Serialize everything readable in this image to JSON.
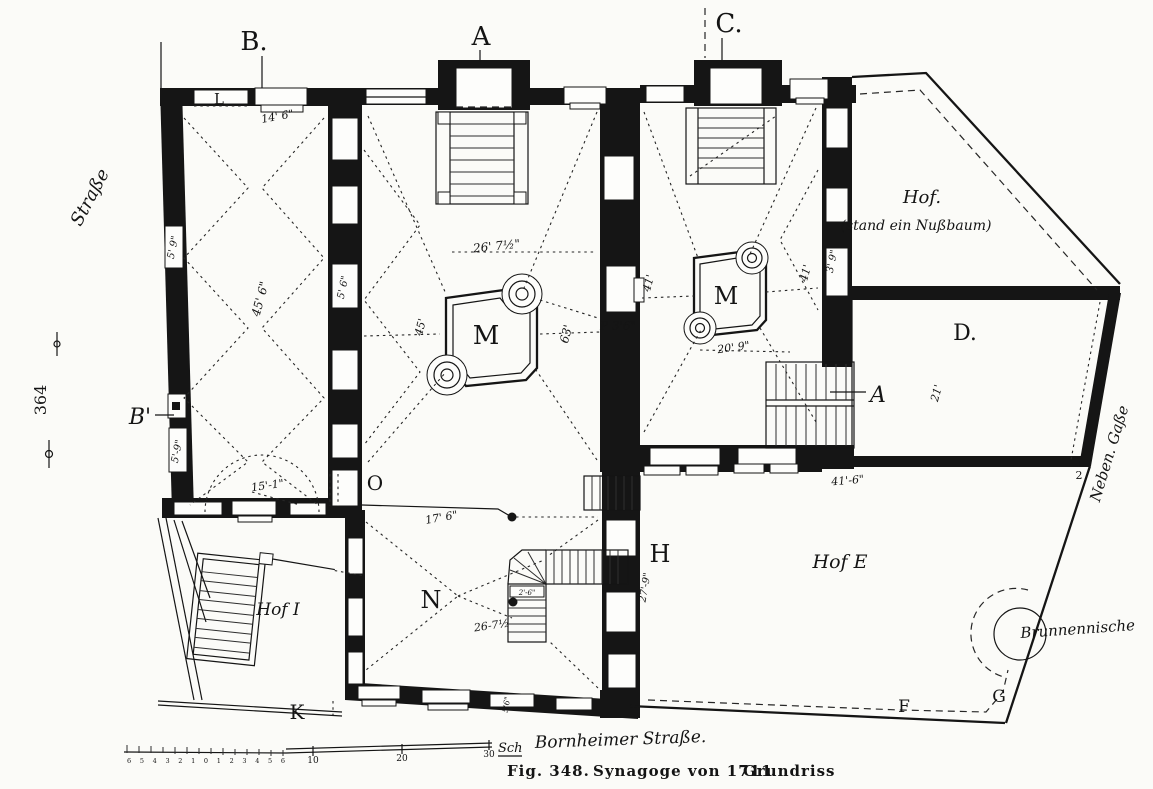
{
  "figure": {
    "caption_fig": "Fig. 348.",
    "caption_title": "Synagoge von 1711",
    "caption_type": "Grundriss",
    "page_number": "364"
  },
  "streets": {
    "left": "Straße",
    "bottom": "Bornheimer Straße.",
    "right": "Neben. Gaße"
  },
  "courtyards": {
    "hof_nussbaum_line1": "Hof.",
    "hof_nussbaum_line2": "(stand ein Nußbaum)",
    "hof_e": "Hof E",
    "hof_i": "Hof I",
    "well_niche": "Brunnennische"
  },
  "markers": {
    "a": "A",
    "b": "B.",
    "c": "C.",
    "b_prime": "B'",
    "l": "L",
    "m_main": "M",
    "m_right": "M",
    "d": "D.",
    "o": "O",
    "n": "N",
    "h": "H",
    "k": "K",
    "f": "F",
    "g": "G",
    "stair_label": "A",
    "corner": "2"
  },
  "dimensions": {
    "top_door": "14' 6\"",
    "left_room_length": "45' 6\"",
    "window_5_9_top": "5' 9\"",
    "window_5_6_mid": "5' 6\"",
    "window_5_9_bottom": "5'-9\"",
    "hall_width": "26' 7½\"",
    "hall_west": "45'",
    "hall_length": "63'",
    "pillar": "P 3'6\"",
    "right_hall_left": "41'",
    "right_hall_right": "41'",
    "window_3_9": "3' 9\"",
    "bimah_right": "20' 9\"",
    "room_d": "21'",
    "hof_i_top": "15'-1\"",
    "room_n_top": "17' 6\"",
    "room_n_width": "26-7½",
    "room_n_east": "27'-9\"",
    "hof_e_top": "41'-6\"",
    "stair_width": "2'-6\"",
    "window_5_6_bottom": "5'6\""
  },
  "scale_bar": {
    "minor_labels": "6 5 4 3 2 1 0 1 2 3 4 5 6",
    "tick_10": "10",
    "tick_20": "20",
    "tick_30": "30",
    "unit": "Sch"
  }
}
